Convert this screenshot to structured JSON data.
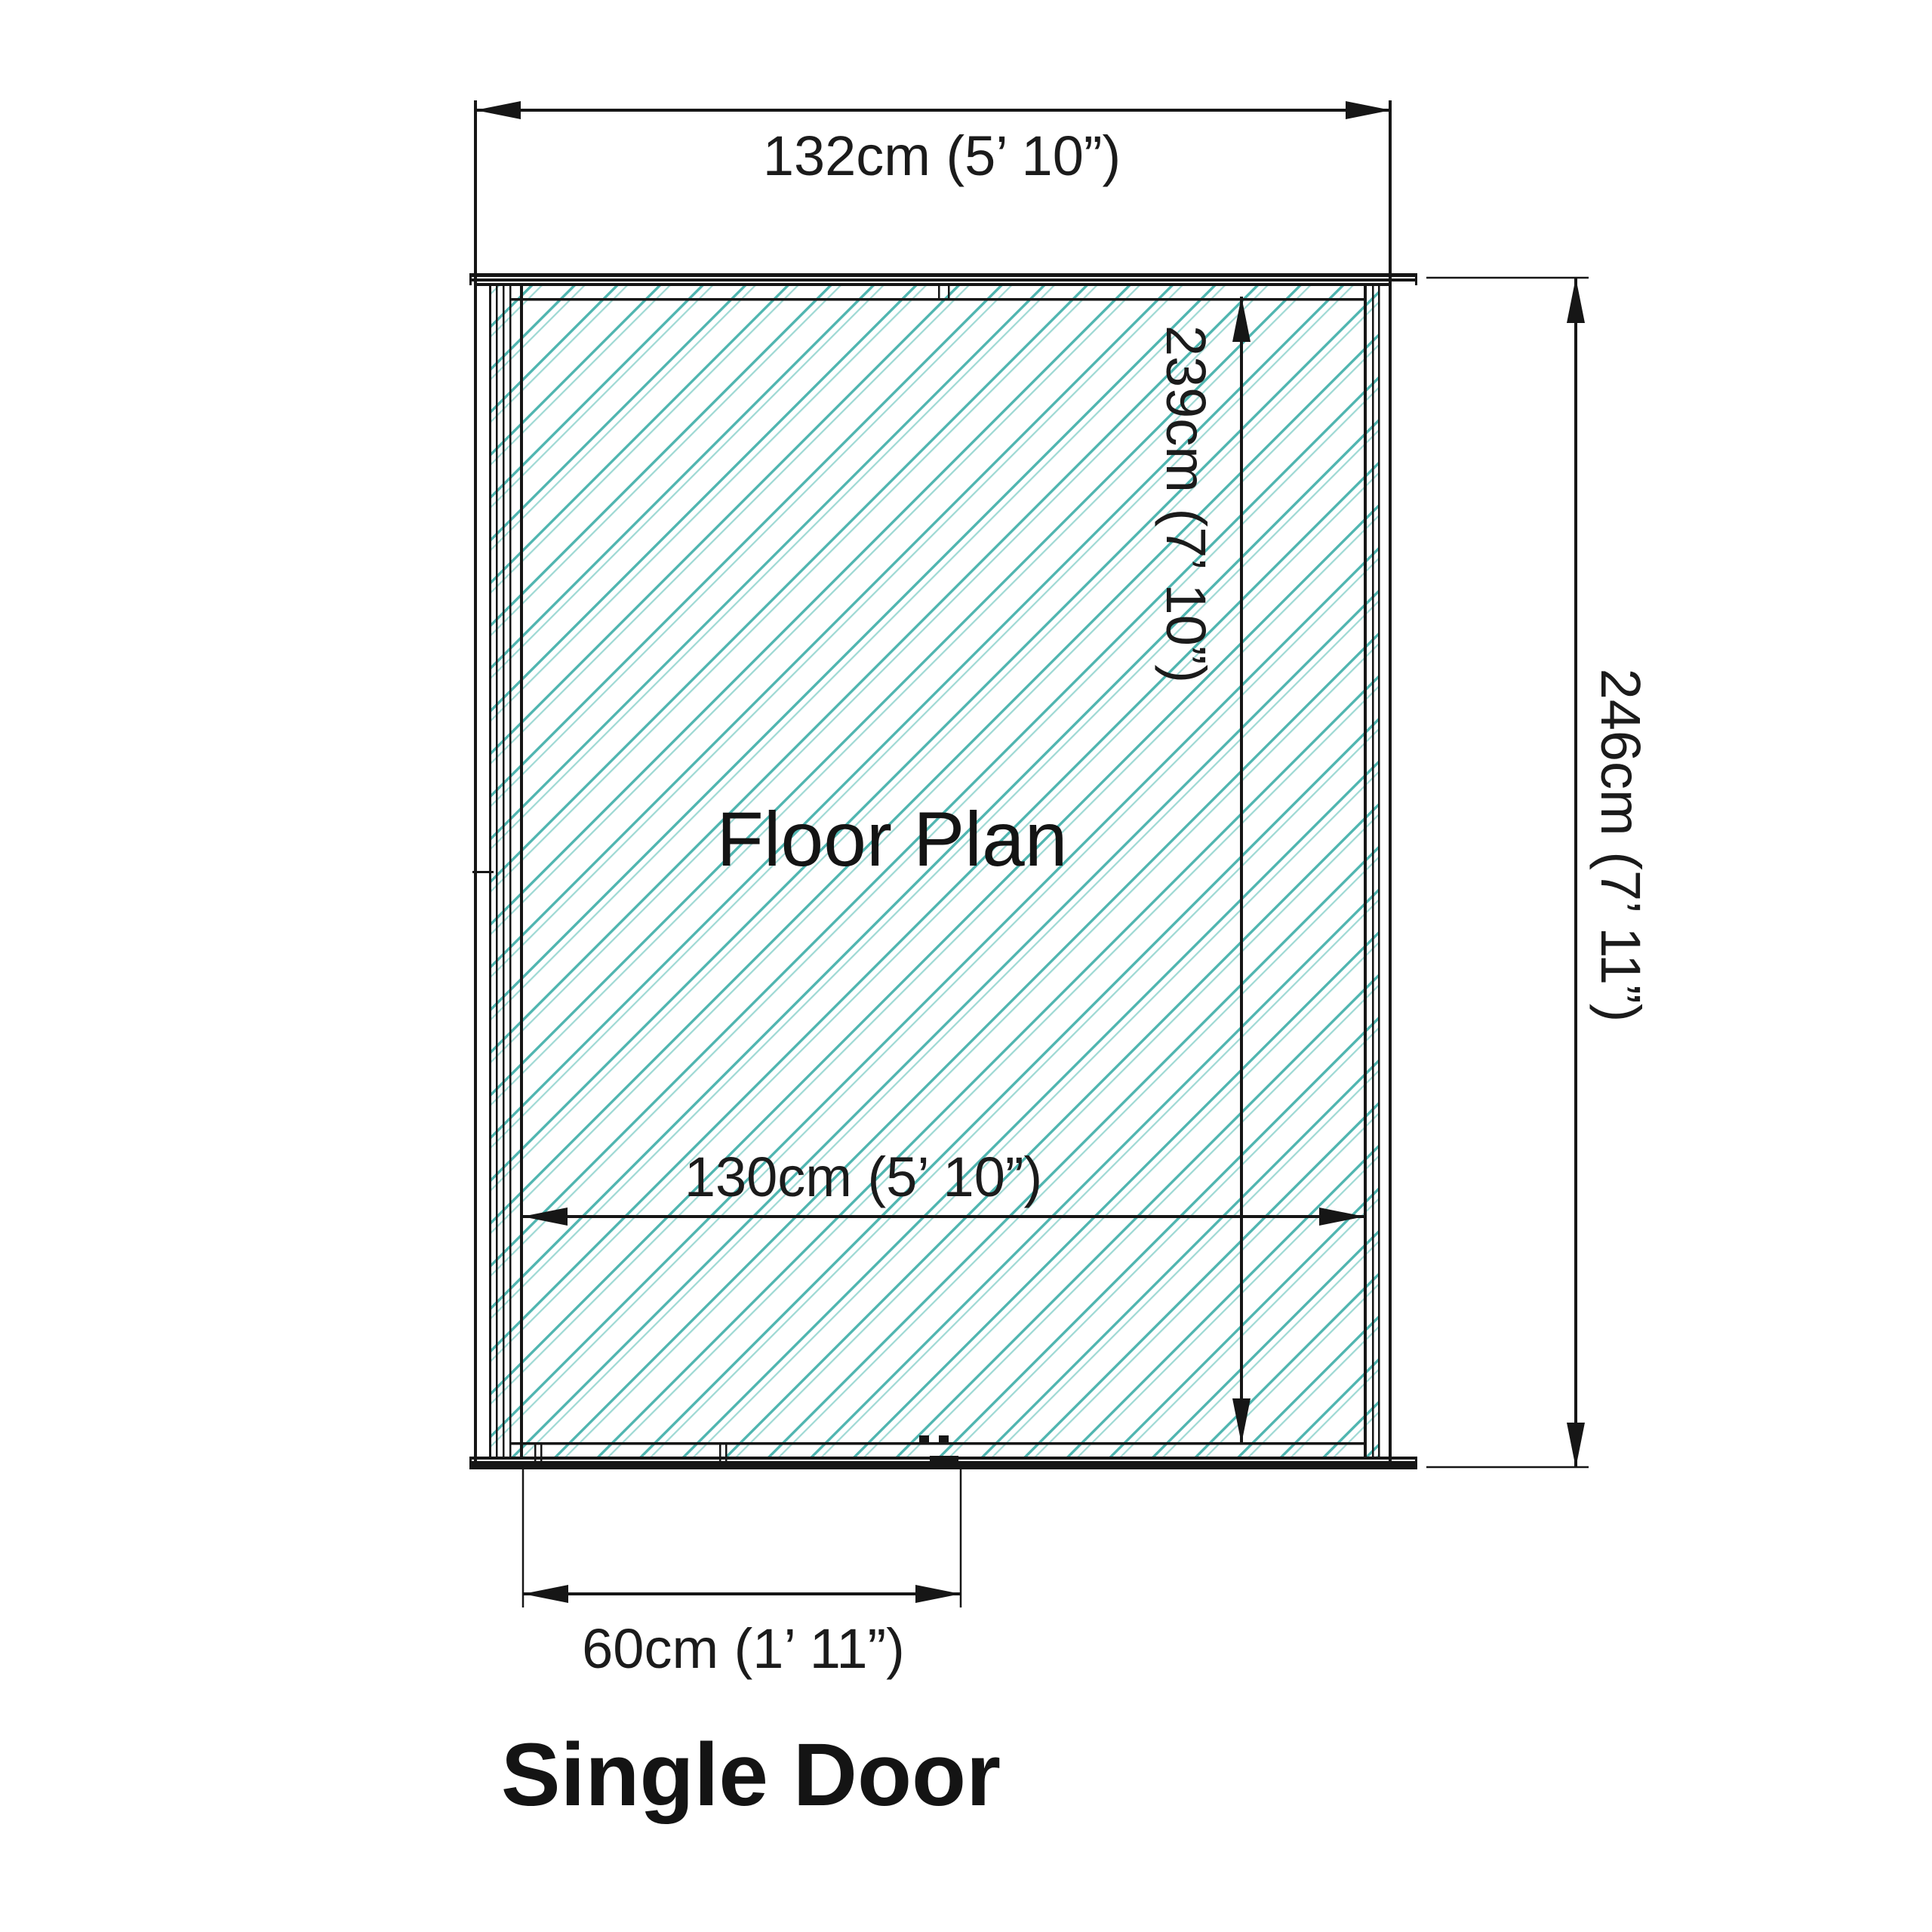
{
  "diagram": {
    "title": "Floor Plan",
    "footer": "Single Door",
    "dimensions": {
      "outer_width": "132cm (5’ 10”)",
      "inner_depth": "239cm (7’ 10”)",
      "outer_depth": "246cm (7’ 11”)",
      "inner_width": "130cm (5’ 10”)",
      "door_width": "60cm (1’ 11”)"
    },
    "colors": {
      "line": "#161616",
      "hatch_primary": "#4fb5b0",
      "hatch_secondary": "#9fd9d4",
      "background": "#ffffff"
    }
  }
}
